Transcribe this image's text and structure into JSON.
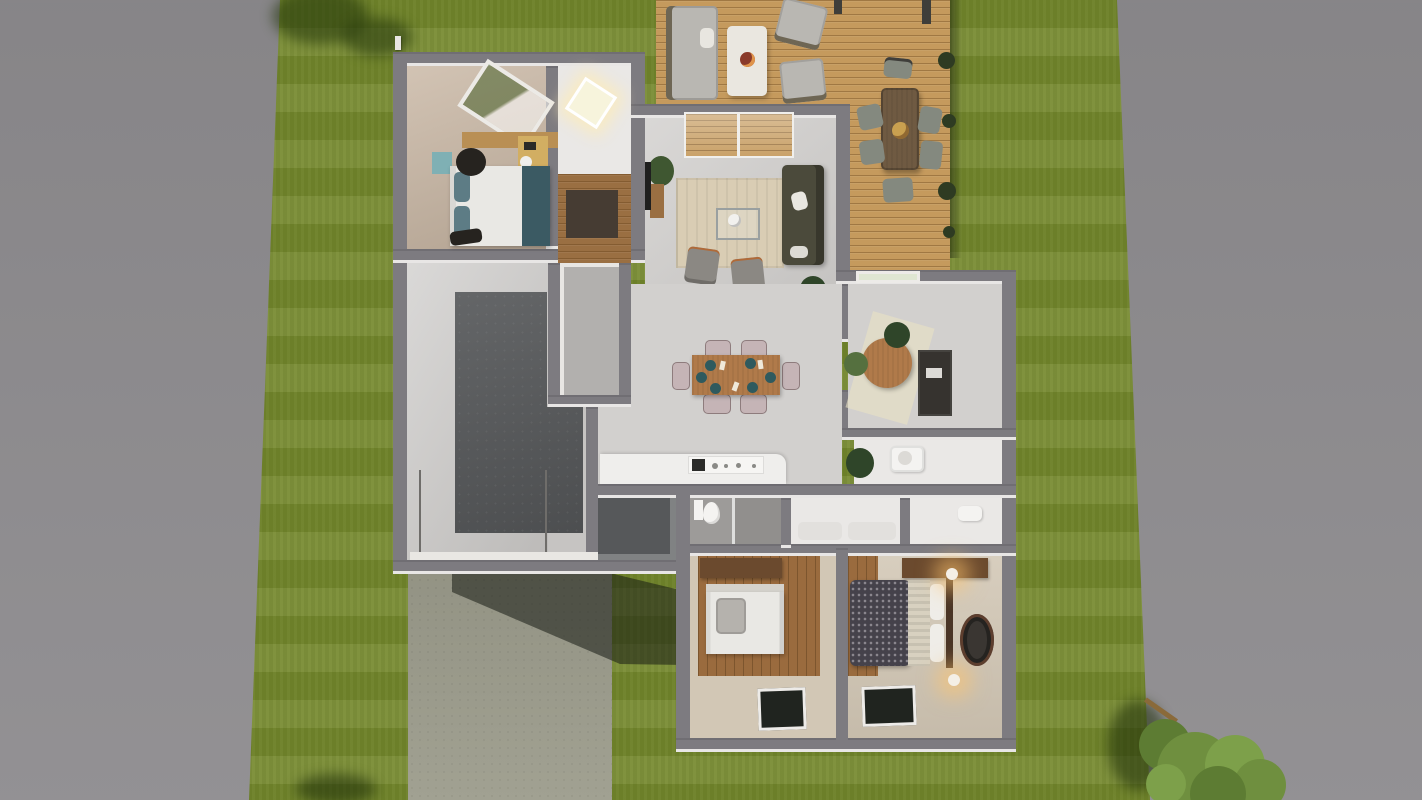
{
  "scene": {
    "label": "Top-down 3D rendering of a single-story house floor plan with surrounding lawn, rear wooden deck, garage and driveway",
    "view": "top-down orthographic",
    "rooms": [
      "bedroom-1",
      "skylight-hallway",
      "entry-hall",
      "living-room",
      "dining-kitchen-great-room",
      "laundry-room",
      "garage",
      "home-office",
      "inner-bathroom",
      "entry-mudroom",
      "bathroom-1",
      "bedroom-hallway",
      "bathroom-2",
      "bedroom-2",
      "master-bedroom"
    ],
    "outdoor": [
      "front-lawn",
      "side-lawn",
      "wood-deck",
      "driveway",
      "corner-tree",
      "roof-vent"
    ],
    "furniture": [
      "double-bed",
      "teal-nightstand",
      "desk",
      "sofa",
      "armchairs",
      "coffee-table",
      "area-rug",
      "dining-table-6-chairs",
      "kitchen-counter-cooktop",
      "round-office-table",
      "office-desk",
      "toilet",
      "shower",
      "sink",
      "single-bed",
      "master-bed",
      "bedside-lamps",
      "round-rug",
      "dressers",
      "outdoor-lounge-set",
      "outdoor-dining-set"
    ]
  },
  "palette": {
    "side_band": "#8c8a8d",
    "grass": "#75882e",
    "deck_wood": "#c59a5d",
    "wall_gray": "#7d7b80",
    "floor_light": "#d2d0ce",
    "floor_white": "#eae8e6",
    "floor_beige": "#c8b6a3",
    "floor_beige_dark": "#d2c7b5",
    "wood_hall": "#9a6f42",
    "wood_bedroom": "#9a6b3e",
    "wood_dresser": "#6b4a2e",
    "wood_strip": "#b98f54",
    "desk_tan": "#d2ae62",
    "garage_base": "#c6c4c2",
    "garage_slab": "#57595b",
    "laundry_floor": "#b2b0ae",
    "driveway": "#9c9c8c",
    "entry_floor": "#56585a",
    "counter_white": "#efeeec",
    "appliance_white": "#f6f5f3",
    "cooktop_dark": "#2b2b29",
    "table_wood": "#b07a4a",
    "chair_pink": "#c5b4b6",
    "plate_teal": "#2f5a5e",
    "sofa_olive": "#4b4a3b",
    "armchair_gray": "#8b8883",
    "rug_living": "#d9cdb4",
    "mat_dark": "#463c33",
    "outdoor_cushion": "#b9b7b2",
    "outdoor_frame": "#6e6654",
    "outdoor_table": "#6f5a42",
    "outdoor_chair": "#84897f",
    "coffee_table_white": "#eae7e0",
    "bowl_red": "#8a3a2a",
    "centerpiece_tan": "#c9a050",
    "post_dark": "#3f3e3a",
    "bush_dark": "#2e3b22",
    "bed_white": "#e9e8e4",
    "headboard_light": "#d5d2cc",
    "pillow_gray": "#b5b2ad",
    "pillow_teal": "#5d7c85",
    "throw_teal": "#3b5a63",
    "nightstand_teal": "#7fb0b4",
    "stool_dark": "#26231f",
    "duvet_dark": "#45424b",
    "duvet_cream": "#d8d1c0",
    "headboard_wood": "#4a3526",
    "rug_round_dark": "#3a3632",
    "lamp_white": "#f4efe6",
    "plant_green": "#3f5731",
    "plant_dark": "#2f4529",
    "chair_green": "#55703f",
    "desk_dark": "#36332f",
    "tv_black": "#1f1f1f",
    "bath_floor": "#9d9b99",
    "shower_floor": "#918f8d",
    "fixture_white": "#f4f3f1",
    "window_dark": "#20241f",
    "tree_green_1": "#6f8f3f",
    "tree_green_2": "#5d7c33",
    "tree_green_3": "#7da04a",
    "branch_brown": "#8a6a3a",
    "sun_patch": "#e9e3c4"
  }
}
